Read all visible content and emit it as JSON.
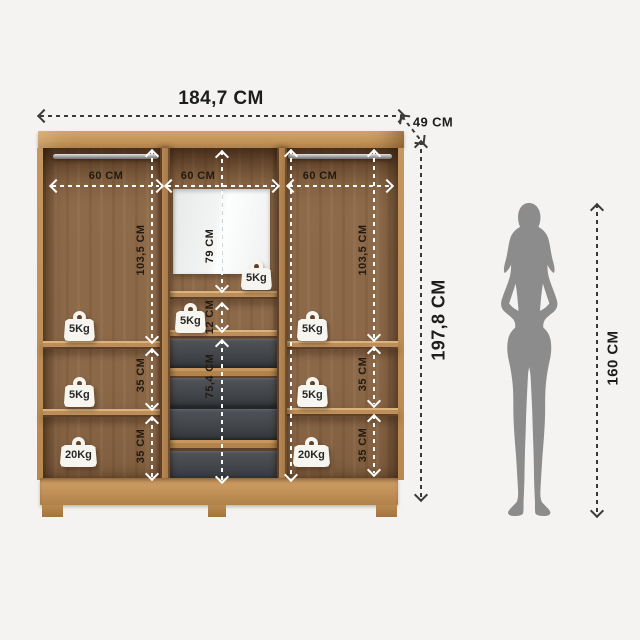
{
  "overall": {
    "width": "184,7 CM",
    "depth": "49 CM",
    "height": "197,8 CM"
  },
  "person": {
    "height": "160 CM"
  },
  "sections": {
    "left": {
      "width": "60 CM",
      "hanging_height": "103,5 CM",
      "gap1": "35 CM",
      "gap2": "35 CM",
      "cap_top": "5Kg",
      "cap_mid": "5Kg",
      "cap_bottom": "20Kg"
    },
    "middle": {
      "width": "60 CM",
      "mirror_height": "79 CM",
      "niche_height": "12 CM",
      "drawers_height": "75,4 CM",
      "cap_mirror": "5Kg",
      "cap_niche": "5Kg"
    },
    "right": {
      "width": "60 CM",
      "hanging_height": "103,5 CM",
      "gap1": "35 CM",
      "gap2": "35 CM",
      "cap_top": "5Kg",
      "cap_mid": "5Kg",
      "cap_bottom": "20Kg"
    }
  },
  "colors": {
    "background": "#f4f3f1",
    "wood_light": "#c89a61",
    "wood_medium": "#8b6848",
    "wood_dark": "#6e4d31",
    "drawer_front": "#42464a",
    "mirror": "#eef0f0",
    "internal_line": "#ffffff",
    "external_line": "#3a3a3a",
    "silhouette": "#8c8c8c",
    "badge_bg": "#f7f5ef",
    "text": "#221a11"
  }
}
